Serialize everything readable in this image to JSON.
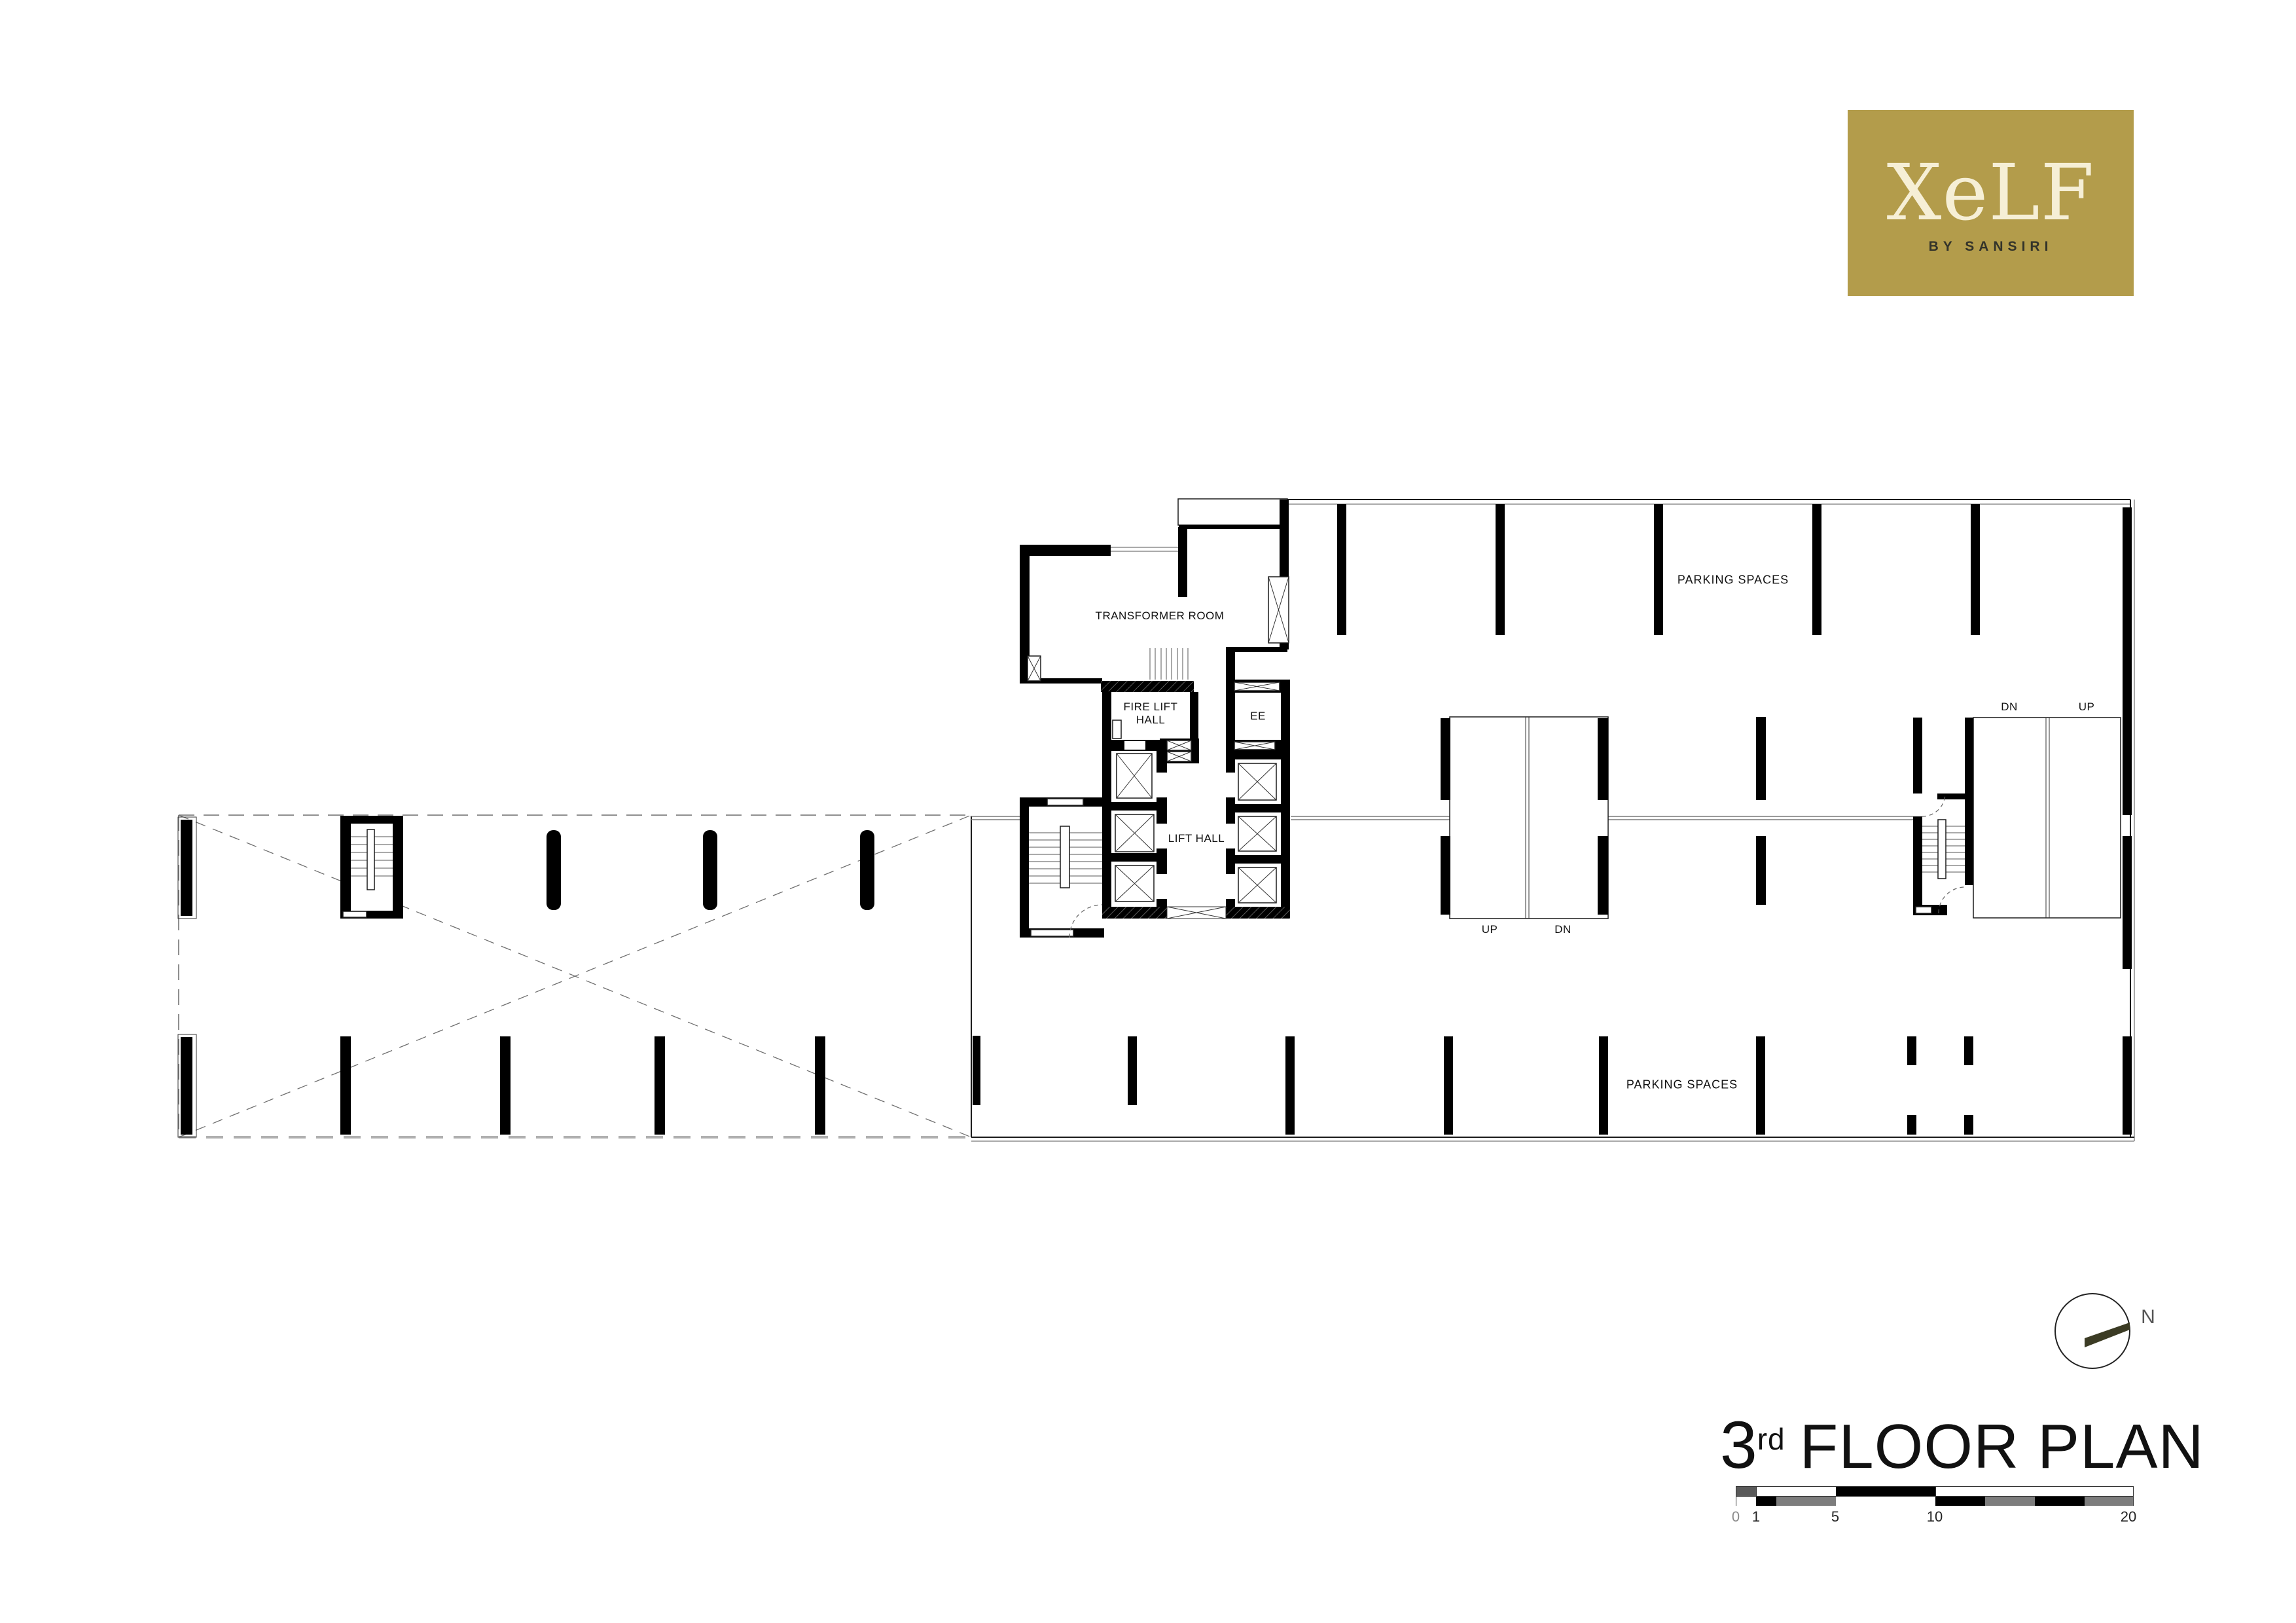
{
  "logo": {
    "brand": "XeLF",
    "tagline": "BY SANSIRI",
    "bg_color": "#b39c4b",
    "brand_color": "#f6efd6",
    "tagline_color": "#33332a"
  },
  "plan": {
    "rooms": {
      "transformer": "TRANSFORMER ROOM",
      "fire_lift_hall_line1": "FIRE LIFT",
      "fire_lift_hall_line2": "HALL",
      "ee": "EE",
      "lift_hall": "LIFT HALL"
    },
    "areas": {
      "parking_top": "PARKING SPACES",
      "parking_bottom": "PARKING SPACES"
    },
    "ramps": {
      "center_up": "UP",
      "center_dn": "DN",
      "right_dn": "DN",
      "right_up": "UP"
    }
  },
  "compass": {
    "label": "N",
    "needle_color": "#3b3b24"
  },
  "title": {
    "number": "3",
    "ordinal": "rd",
    "text": "FLOOR PLAN"
  },
  "scale_bar": {
    "ticks": [
      "0",
      "1",
      "5",
      "10",
      "20"
    ]
  }
}
